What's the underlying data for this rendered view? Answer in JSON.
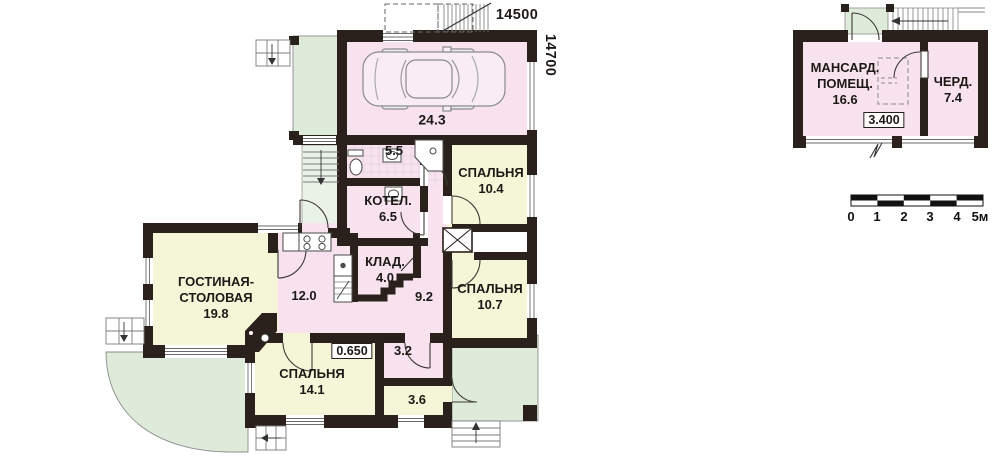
{
  "palette": {
    "wall": "#2b211c",
    "room_pink": "#f7e2ee",
    "room_yellow": "#f5f5d7",
    "terrace_green": "#dfebda",
    "steps_green": "#eaf2e7",
    "text": "#1d1916"
  },
  "main_floor": {
    "rooms": [
      {
        "id": "garage",
        "area": "24.3"
      },
      {
        "id": "bathroom",
        "area": "5.5"
      },
      {
        "id": "boiler",
        "name": "КОТЕЛ.",
        "area": "6.5"
      },
      {
        "id": "bedroom1",
        "name": "СПАЛЬНЯ",
        "area": "10.4"
      },
      {
        "id": "living",
        "name1": "ГОСТИНАЯ-",
        "name2": "СТОЛОВАЯ",
        "area": "19.8"
      },
      {
        "id": "kitchen",
        "area": "12.0"
      },
      {
        "id": "storage",
        "name": "КЛАД.",
        "area": "4.0"
      },
      {
        "id": "hall",
        "area": "9.2"
      },
      {
        "id": "bedroom2",
        "name": "СПАЛЬНЯ",
        "area": "10.7"
      },
      {
        "id": "bedroom3",
        "name": "СПАЛЬНЯ",
        "area": "14.1"
      },
      {
        "id": "entry",
        "area": "3.2"
      },
      {
        "id": "wc",
        "area": "3.6"
      }
    ],
    "elevation": "0.650",
    "dim_width": "14500",
    "dim_height": "14700"
  },
  "attic": {
    "rooms": [
      {
        "id": "attic-room",
        "name1": "МАНСАРД.",
        "name2": "ПОМЕЩ.",
        "area": "16.6"
      },
      {
        "id": "loft",
        "name": "ЧЕРД.",
        "area": "7.4"
      }
    ],
    "elevation": "3.400"
  },
  "scale_bar": {
    "labels": [
      "0",
      "1",
      "2",
      "3",
      "4",
      "5м"
    ]
  },
  "icons": [
    "car-icon",
    "toilet-icon",
    "washbasin-icon",
    "boiler-icon",
    "shower-icon",
    "stove-icon",
    "kitchen-sink-icon",
    "cellar-stairs-icon",
    "fireplace-icon",
    "ventilation-shaft-icon",
    "stairs-icon",
    "entrance-stairs-icon",
    "scale-bar"
  ]
}
